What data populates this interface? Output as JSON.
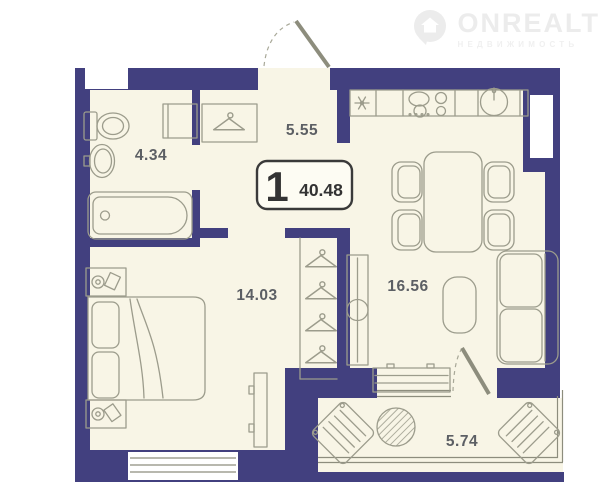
{
  "logo": {
    "brand": "ONREALT",
    "subtitle": "НЕДВИЖИМОСТЬ",
    "icon": "house-pin-icon",
    "color": "#ececec"
  },
  "plan": {
    "badge": {
      "rooms": "1",
      "area": "40.48"
    },
    "rooms": [
      {
        "name": "bathroom",
        "area": "4.34",
        "fixtures": [
          "toilet",
          "sink",
          "bathtub",
          "washing-machine"
        ]
      },
      {
        "name": "hallway",
        "area": "5.55",
        "fixtures": [
          "entrance-door",
          "coat-rack-hanger"
        ]
      },
      {
        "name": "bedroom",
        "area": "14.03",
        "fixtures": [
          "double-bed",
          "nightstand",
          "nightstand",
          "tv-stand",
          "wardrobe-hangers",
          "window"
        ]
      },
      {
        "name": "kitchen-living-room",
        "area": "16.56",
        "fixtures": [
          "fridge",
          "stove",
          "kitchen-sink",
          "dining-table",
          "chair",
          "chair",
          "chair",
          "chair",
          "sofa",
          "coffee-table",
          "tv-cabinet",
          "wardrobe",
          "balcony-door"
        ]
      },
      {
        "name": "balcony",
        "area": "5.74",
        "fixtures": [
          "lounge-chair",
          "round-table",
          "lounge-chair"
        ]
      }
    ],
    "colors": {
      "wall": "#42407f",
      "floor": "#f8f5e6",
      "furniture_line": "#9c9c8c",
      "label": "#5c5f64",
      "badge_text": "#333333"
    }
  }
}
